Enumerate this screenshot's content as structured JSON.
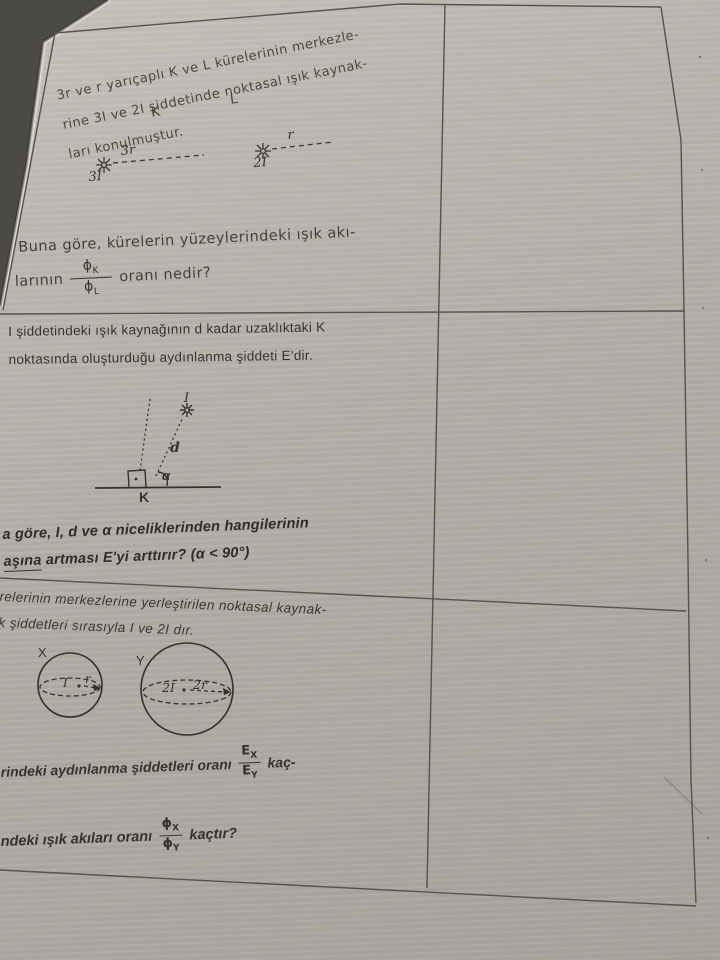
{
  "page": {
    "background": "#4b4a47",
    "paper": "#b4b0aa",
    "ink": "#36332d"
  },
  "q1": {
    "statement_lines": [
      "3r ve r yarıçaplı K ve L kürelerinin merkezle-",
      "rine 3I ve 2I şiddetinde noktasal ışık kaynak-",
      "ları konulmuştur."
    ],
    "diagram": {
      "sphere_k": "K",
      "sphere_l": "L",
      "source_k": "3I",
      "radius_k": "3r",
      "source_l": "2I",
      "radius_l": "r"
    },
    "question_line1": "Buna göre, kürelerin yüzeylerindeki ışık akı-",
    "question_prefix": "larının",
    "question_suffix": "oranı nedir?",
    "flux_fraction": {
      "num": "ϕ",
      "num_sub": "K",
      "den": "ϕ",
      "den_sub": "L"
    }
  },
  "q2": {
    "statement_lines": [
      "I şiddetindeki ışık kaynağının d kadar uzaklıktaki K",
      "noktasında oluşturduğu aydınlanma şiddeti E'dir."
    ],
    "diagram": {
      "source": "I",
      "distance": "d",
      "angle": "α",
      "point": "K"
    },
    "question_line1": "a göre, I, d ve α niceliklerinden hangilerinin",
    "question_line2_underlined": "aşına",
    "question_line2_rest": " artması E'yi arttırır? (α < 90°)"
  },
  "q3": {
    "statement_lines": [
      "relerinin merkezlerine yerleştirilen noktasal kaynak-",
      "k şiddetleri sırasıyla I ve 2I dır."
    ],
    "diagram": {
      "sphere_x": "X",
      "sphere_y": "Y",
      "source_x": "I",
      "radius_x": "r",
      "source_y": "2I",
      "radius_y": "2r"
    },
    "question1_prefix": "rindeki aydınlanma şiddetleri oranı",
    "question1_suffix": "kaç-",
    "intensity_fraction": {
      "num": "E",
      "num_sub": "X",
      "den": "E",
      "den_sub": "Y"
    },
    "question2_prefix": "ndeki ışık akıları oranı",
    "question2_suffix": "kaçtır?",
    "flux_fraction": {
      "num": "ϕ",
      "num_sub": "X",
      "den": "ϕ",
      "den_sub": "Y"
    }
  }
}
